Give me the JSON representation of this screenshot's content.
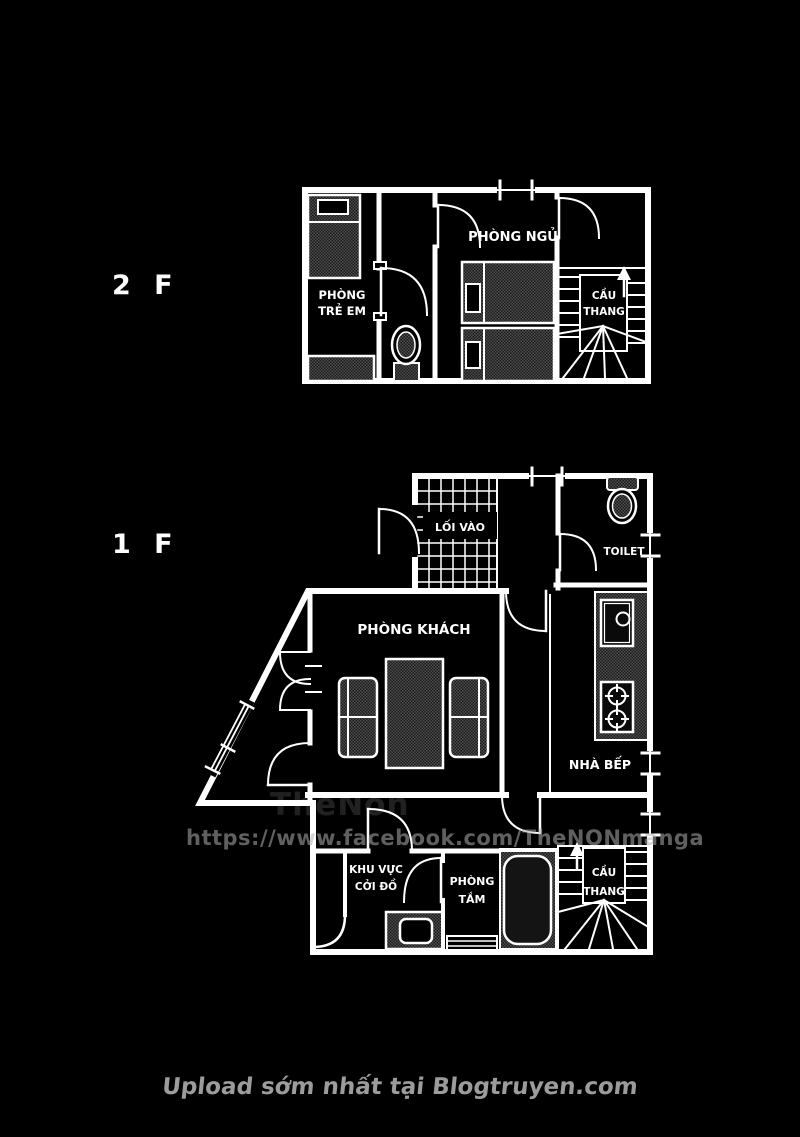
{
  "colors": {
    "background": "#000000",
    "line": "#ffffff",
    "furniture_fill": "#3a3a3a",
    "watermark_url": "#3f3f3f",
    "caption": "#9c9c9c"
  },
  "floor2": {
    "floor_label": "2 F",
    "rooms": {
      "kids_room": {
        "line1": "PHÒNG",
        "line2": "TRẺ EM"
      },
      "bedroom": "PHÒNG NGỦ",
      "stairs": {
        "line1": "CẦU",
        "line2": "THANG"
      }
    }
  },
  "floor1": {
    "floor_label": "1 F",
    "rooms": {
      "entrance": "LỐI VÀO",
      "toilet": "TOILET",
      "living_room": "PHÒNG KHÁCH",
      "kitchen": "NHÀ BẾP",
      "changing_area": {
        "line1": "KHU VỰC",
        "line2": "CỞI ĐỒ"
      },
      "bathroom": {
        "line1": "PHÒNG",
        "line2": "TẮM"
      },
      "stairs": {
        "line1": "CẦU",
        "line2": "THANG"
      }
    }
  },
  "watermark": {
    "name": "TheNon",
    "url": "https://www.facebook.com/TheNONmanga"
  },
  "footer": {
    "caption": "Upload sớm nhất tại Blogtruyen.com"
  }
}
